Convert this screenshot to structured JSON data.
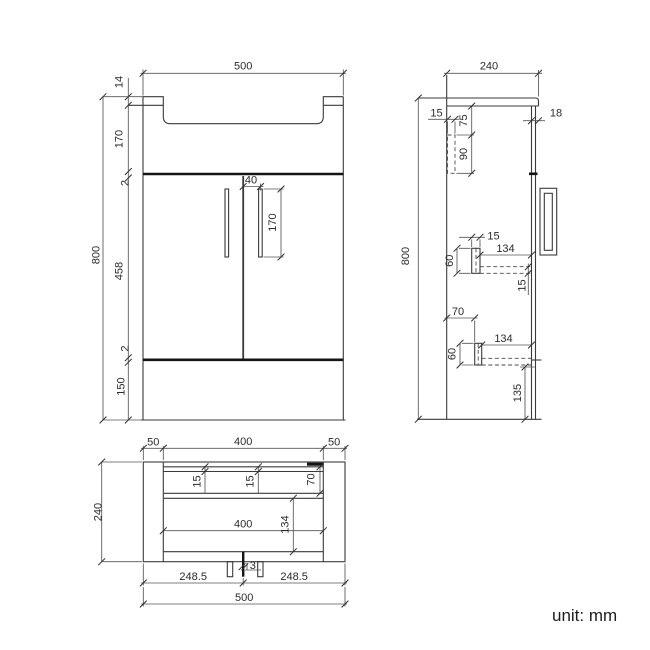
{
  "unit_label": "unit: mm",
  "front": {
    "width": "500",
    "height": "800",
    "chain": [
      "14",
      "170",
      "2",
      "458",
      "2",
      "150"
    ],
    "handle_offset": "40",
    "handle_length": "170"
  },
  "side": {
    "width": "240",
    "height": "800",
    "bracket_width": "15",
    "bracket_top": "75",
    "bracket_len": "90",
    "counter_overhang": "18",
    "upper_bracket_width": "15",
    "upper_rail_length": "134",
    "upper_bracket_height": "60",
    "upper_rail_thickness": "15",
    "lower_offset": "70",
    "lower_rail_length": "134",
    "lower_bracket_height": "60",
    "lower_bottom": "135"
  },
  "plan": {
    "top_left": "50",
    "top_mid": "400",
    "top_right": "50",
    "depth": "240",
    "back_inset_a": "15",
    "back_inset_b": "15",
    "corner": "70",
    "inner_width": "400",
    "front_depth": "134",
    "door_gap": "3",
    "door_left": "248.5",
    "door_right": "248.5",
    "overall_width": "500"
  }
}
